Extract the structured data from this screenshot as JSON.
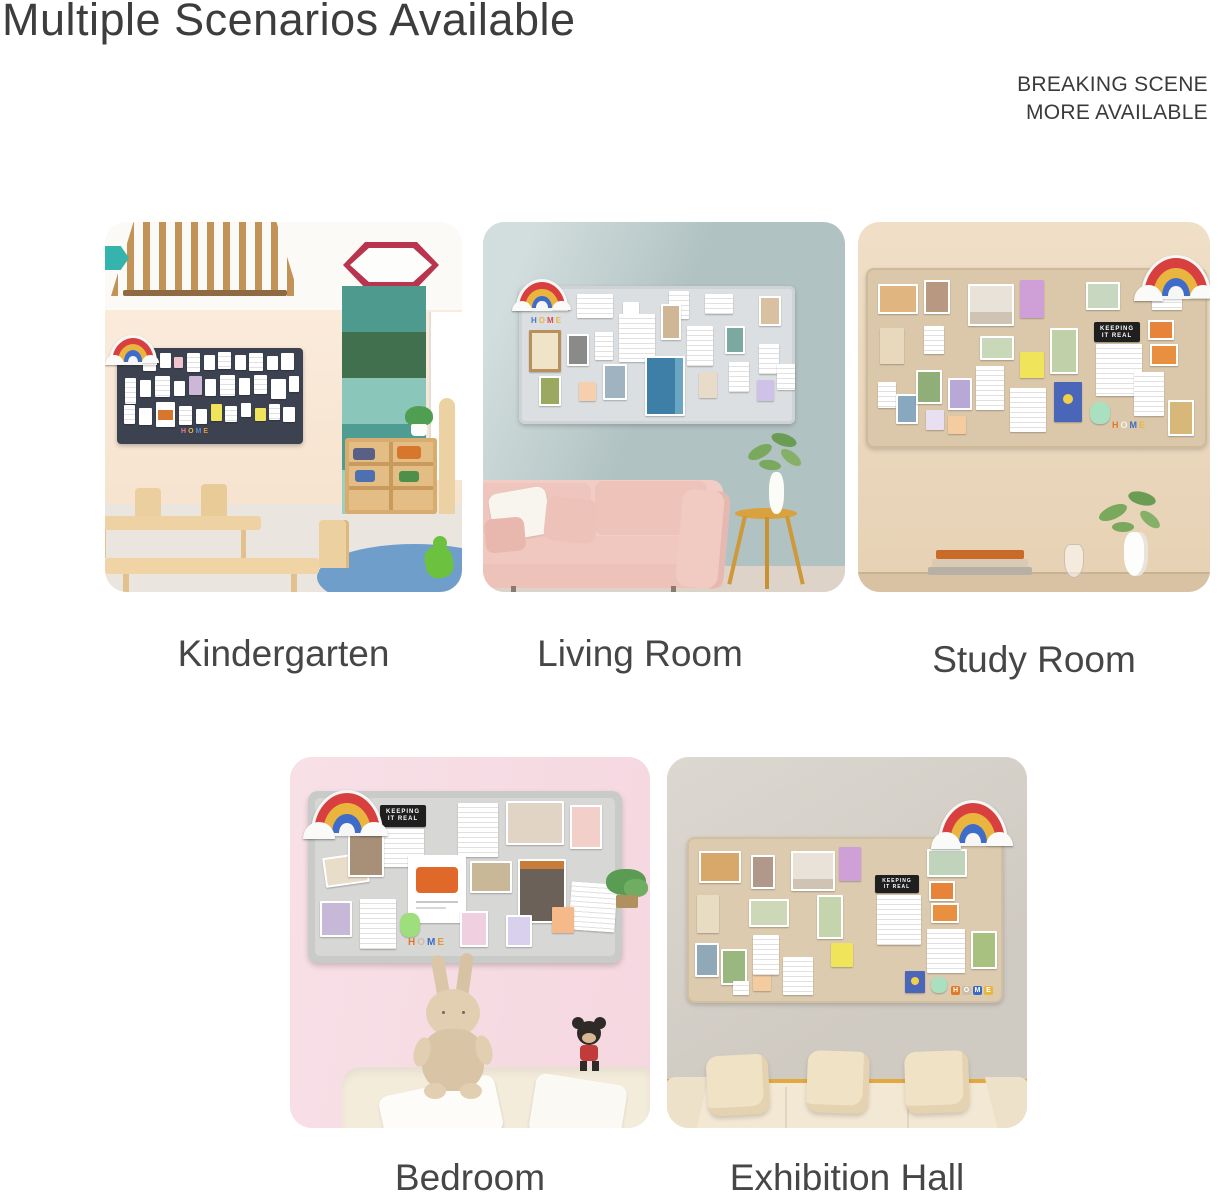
{
  "page": {
    "title": "Multiple Scenarios Available",
    "corner_note_line1": "BREAKING SCENE",
    "corner_note_line2": "MORE AVAILABLE",
    "text_color": "#3d3d3d",
    "background_color": "#ffffff"
  },
  "scenarios": [
    {
      "label": "Kindergarten",
      "wall_color": "#f9e9d6",
      "board_color": "#3c4250"
    },
    {
      "label": "Living Room",
      "wall_color": "#b1c2c2",
      "board_color": "#dcdfe1"
    },
    {
      "label": "Study Room",
      "wall_color": "#eedcc3",
      "board_color": "#dbc8ab"
    },
    {
      "label": "Bedroom",
      "wall_color": "#f7dde5",
      "board_color": "#d7d8d6"
    },
    {
      "label": "Exhibition Hall",
      "wall_color": "#d5d1c9",
      "board_color": "#ddcbaf"
    }
  ],
  "board_decor": {
    "sign_line1": "KEEPING",
    "sign_line2": "IT REAL",
    "home_letters": [
      "H",
      "O",
      "M",
      "E"
    ],
    "rainbow_colors": [
      "#d84040",
      "#eab53e",
      "#3e6cc8"
    ]
  },
  "icons": {
    "rainbow_sticker": "css-arc-shapes",
    "cloud_puff": "css-ellipse"
  }
}
